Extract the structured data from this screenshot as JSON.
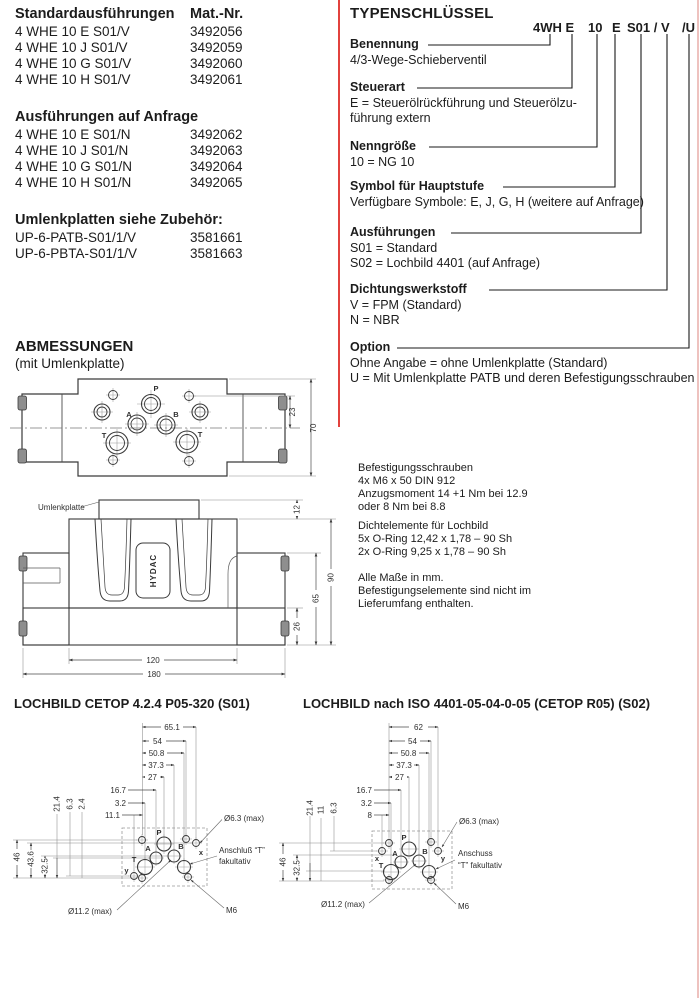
{
  "parts": {
    "standard": {
      "title": "Standardausführungen",
      "col": "Mat.-Nr.",
      "rows": [
        {
          "m": "4 WHE 10 E S01/V",
          "n": "3492056"
        },
        {
          "m": "4 WHE 10 J S01/V",
          "n": "3492059"
        },
        {
          "m": "4 WHE 10 G S01/V",
          "n": "3492060"
        },
        {
          "m": "4 WHE 10 H S01/V",
          "n": "3492061"
        }
      ]
    },
    "anfrage": {
      "title": "Ausführungen auf Anfrage",
      "rows": [
        {
          "m": "4 WHE 10 E S01/N",
          "n": "3492062"
        },
        {
          "m": "4 WHE 10 J S01/N",
          "n": "3492063"
        },
        {
          "m": "4 WHE 10 G S01/N",
          "n": "3492064"
        },
        {
          "m": "4 WHE 10 H S01/N",
          "n": "3492065"
        }
      ]
    },
    "umlenk": {
      "title": "Umlenkplatten siehe Zubehör:",
      "rows": [
        {
          "m": "UP-6-PATB-S01/1/V",
          "n": "3581661"
        },
        {
          "m": "UP-6-PBTA-S01/1/V",
          "n": "3581663"
        }
      ]
    }
  },
  "typ": {
    "title": "TYPENSCHLÜSSEL",
    "code": [
      "4WH E",
      "10",
      "E",
      "S01 / V",
      "/U"
    ],
    "sections": [
      {
        "label": "Benennung",
        "lines": [
          "4/3-Wege-Schieberventil"
        ]
      },
      {
        "label": "Steuerart",
        "lines": [
          "E = Steuerölrückführung und Steuerölzu-",
          "führung extern"
        ]
      },
      {
        "label": "Nenngröße",
        "lines": [
          "10 = NG 10"
        ]
      },
      {
        "label": "Symbol für Hauptstufe",
        "lines": [
          "Verfügbare Symbole: E, J, G, H (weitere auf Anfrage)"
        ]
      },
      {
        "label": "Ausführungen",
        "lines": [
          "S01 = Standard",
          "S02 = Lochbild 4401 (auf Anfrage)"
        ]
      },
      {
        "label": "Dichtungswerkstoff",
        "lines": [
          "V = FPM (Standard)",
          "N = NBR"
        ]
      },
      {
        "label": "Option",
        "lines": [
          "Ohne Angabe = ohne Umlenkplatte (Standard)",
          "U = Mit Umlenkplatte PATB und deren Befestigungsschrauben"
        ]
      }
    ]
  },
  "abm": {
    "title": "ABMESSUNGEN",
    "subtitle": "(mit Umlenkplatte)",
    "top": {
      "p": "P",
      "a": "A",
      "b": "B",
      "tl": "T",
      "tr": "T",
      "d23": "23",
      "d70": "70"
    },
    "front": {
      "plate": "Umlenkplatte",
      "logo": "HYDAC",
      "d12": "12",
      "d90": "90",
      "d65": "65",
      "d26": "26",
      "d120": "120",
      "d180": "180"
    }
  },
  "notes": {
    "b1": [
      "Befestigungsschrauben",
      "4x M6 x 50 DIN 912",
      "Anzugsmoment 14 +1 Nm bei 12.9",
      "oder 8 Nm bei 8.8"
    ],
    "b2": [
      "Dichtelemente für Lochbild",
      "5x O-Ring 12,42 x 1,78 – 90 Sh",
      "2x O-Ring 9,25 x 1,78 – 90 Sh"
    ],
    "b3": [
      "Alle Maße in mm.",
      "Befestigungselemente sind nicht im",
      "Lieferumfang enthalten."
    ]
  },
  "l1": {
    "title": "LOCHBILD CETOP 4.2.4 P05-320 (S01)",
    "dims": [
      "65.1",
      "54",
      "50.8",
      "37.3",
      "27",
      "16.7",
      "3.2",
      "11.1"
    ],
    "vdims": [
      "46",
      "43.6",
      "32.5",
      "21.4",
      "6.3",
      "2.4"
    ],
    "ports": {
      "p": "P",
      "a": "A",
      "b": "B",
      "t": "T",
      "x": "x",
      "y": "y"
    },
    "lab": {
      "d63": "Ø6.3 (max)",
      "t1": "Anschluß “T”",
      "t2": "fakultativ",
      "d112": "Ø11.2 (max)",
      "m6": "M6"
    }
  },
  "l2": {
    "title": "LOCHBILD nach ISO 4401-05-04-0-05 (CETOP R05) (S02)",
    "dims": [
      "62",
      "54",
      "50.8",
      "37.3",
      "27",
      "16.7",
      "3.2",
      "8"
    ],
    "vdims": [
      "46",
      "32.5",
      "21.4",
      "11",
      "6.3"
    ],
    "ports": {
      "p": "P",
      "a": "A",
      "b": "B",
      "t": "T",
      "x": "x",
      "y": "y"
    },
    "lab": {
      "d63": "Ø6.3 (max)",
      "t1": "Anschuss",
      "t2": "“T” fakultativ",
      "d112": "Ø11.2 (max)",
      "m6": "M6"
    }
  }
}
